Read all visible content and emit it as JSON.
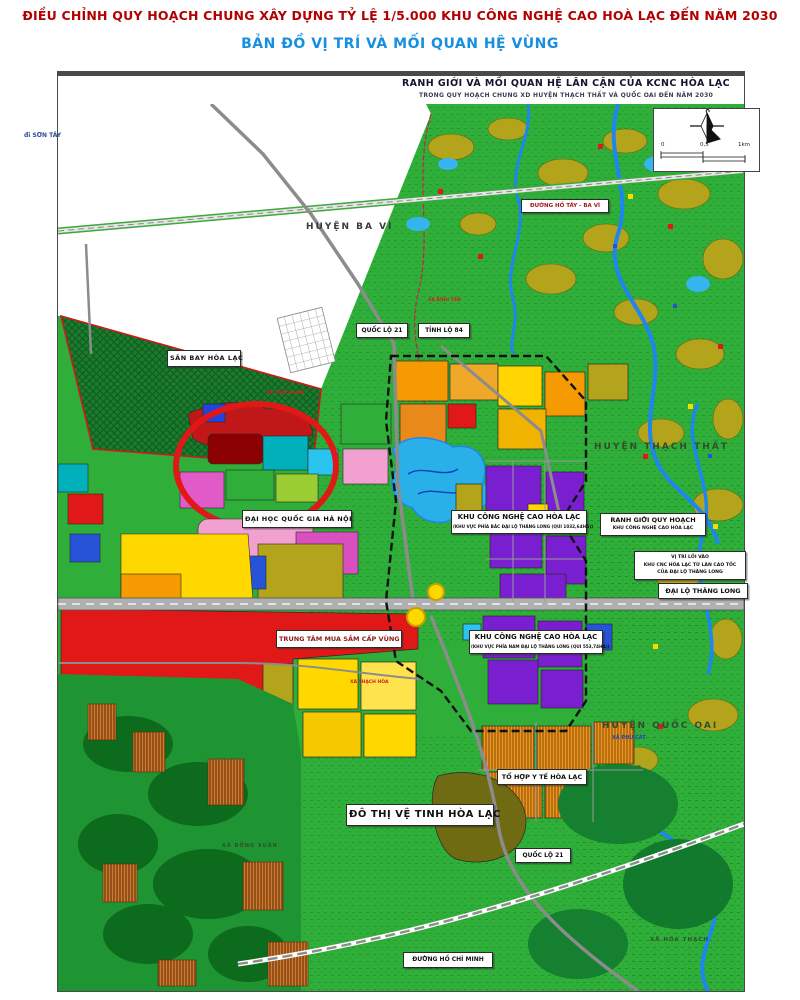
{
  "page": {
    "title": "ĐIỀU CHỈNH QUY HOẠCH CHUNG XÂY DỰNG TỶ LỆ 1/5.000 KHU CÔNG NGHỆ CAO HOÀ LẠC ĐẾN NĂM 2030",
    "subtitle": "BẢN ĐỒ VỊ TRÍ VÀ MỐI QUAN HỆ VÙNG"
  },
  "map": {
    "header": {
      "line1": "RANH GIỚI VÀ MỐI QUAN HỆ LÂN CẬN CỦA KCNC HÒA LẠC",
      "line2": "TRONG QUY HOẠCH CHUNG XD HUYỆN THẠCH THẤT VÀ QUỐC OAI ĐẾN NĂM 2030"
    },
    "scale": {
      "left": "0",
      "mid": "0,5",
      "right": "1km"
    },
    "labels": {
      "di_son_tay": "đi SƠN TÂY",
      "huyen_ba_vi": "HUYỆN BA VÌ",
      "duong_ho_tay_ba_vi": "ĐƯỜNG HỒ TÂY - BA VÌ",
      "san_bay_hoa_lac": "SÂN BAY HÒA LẠC",
      "quoc_lo_21_north": "QUỐC LỘ 21",
      "tinh_lo_84": "TỈNH LỘ 84",
      "dai_hoc_quoc_gia": "ĐẠI HỌC QUỐC GIA HÀ NỘI",
      "khu_cnc_bac": {
        "line1": "KHU CÔNG NGHỆ CAO HÒA LẠC",
        "line2": "(KHU VỰC PHÍA BẮC ĐẠI LỘ THĂNG LONG (QUI 1032,64HA))"
      },
      "huyen_thach_that": "HUYỆN THẠCH THẤT",
      "ranh_gioi": {
        "line1": "RANH GIỚI QUY HOẠCH",
        "line2": "KHU CÔNG NGHỆ CAO HÒA LẠC"
      },
      "vi_tri_loi_vao": {
        "line1": "VỊ TRÍ LỐI VÀO",
        "line2": "KHU CNC HÒA LẠC TỪ LÀN CAO TỐC",
        "line3": "CỦA ĐẠI LỘ THĂNG LONG"
      },
      "dai_lo_thang_long": "ĐẠI LỘ THĂNG LONG",
      "trung_tam_mua_sam": "TRUNG TÂM MUA SẮM CẤP VÙNG",
      "khu_cnc_nam": {
        "line1": "KHU CÔNG NGHỆ CAO HÒA LẠC",
        "line2": "(KHU VỰC PHÍA NAM ĐẠI LỘ THĂNG LONG (QUI 553,74HA))"
      },
      "huyen_quoc_oai": "HUYỆN QUỐC OAI",
      "xa_phu_cat": "XÃ PHÚ CÁT",
      "to_hop_y_te": "TỔ HỢP Y TẾ HÒA LẠC",
      "do_thi_ve_tinh": "ĐÔ THỊ VỆ TINH HÒA LẠC",
      "quoc_lo_21_south": "QUỐC LỘ 21",
      "duong_ho_chi_minh": "ĐƯỜNG HỒ CHÍ MINH",
      "xa_hoa_thach": "XÃ HÒA THẠCH",
      "xa_binh_yen": "XÃ BÌNH YÊN",
      "xa_thach_hoa_1": "XÃ THẠCH HÒA",
      "xa_thach_hoa_2": "XÃ THẠCH HÒA",
      "xa_dong_xuan": "XÃ ĐỒNG XUÂN"
    },
    "colors": {
      "title_red": "#b30000",
      "subtitle_blue": "#168fe0",
      "rural_green": "#2fae39",
      "forest_dark": "#0c6b1c",
      "water_blue": "#1d86f0",
      "lake_cyan": "#2ab0e8",
      "urban_orange": "#f59a00",
      "urban_yellow": "#ffd800",
      "hitech_purple": "#7a1fd0",
      "urban_red": "#e01818",
      "village_olive": "#b3a41c",
      "pink": "#f2a0d0",
      "road_gray": "#9a9a9a",
      "airport_green": "#1c7a2e",
      "boundary_black": "#111111"
    }
  }
}
